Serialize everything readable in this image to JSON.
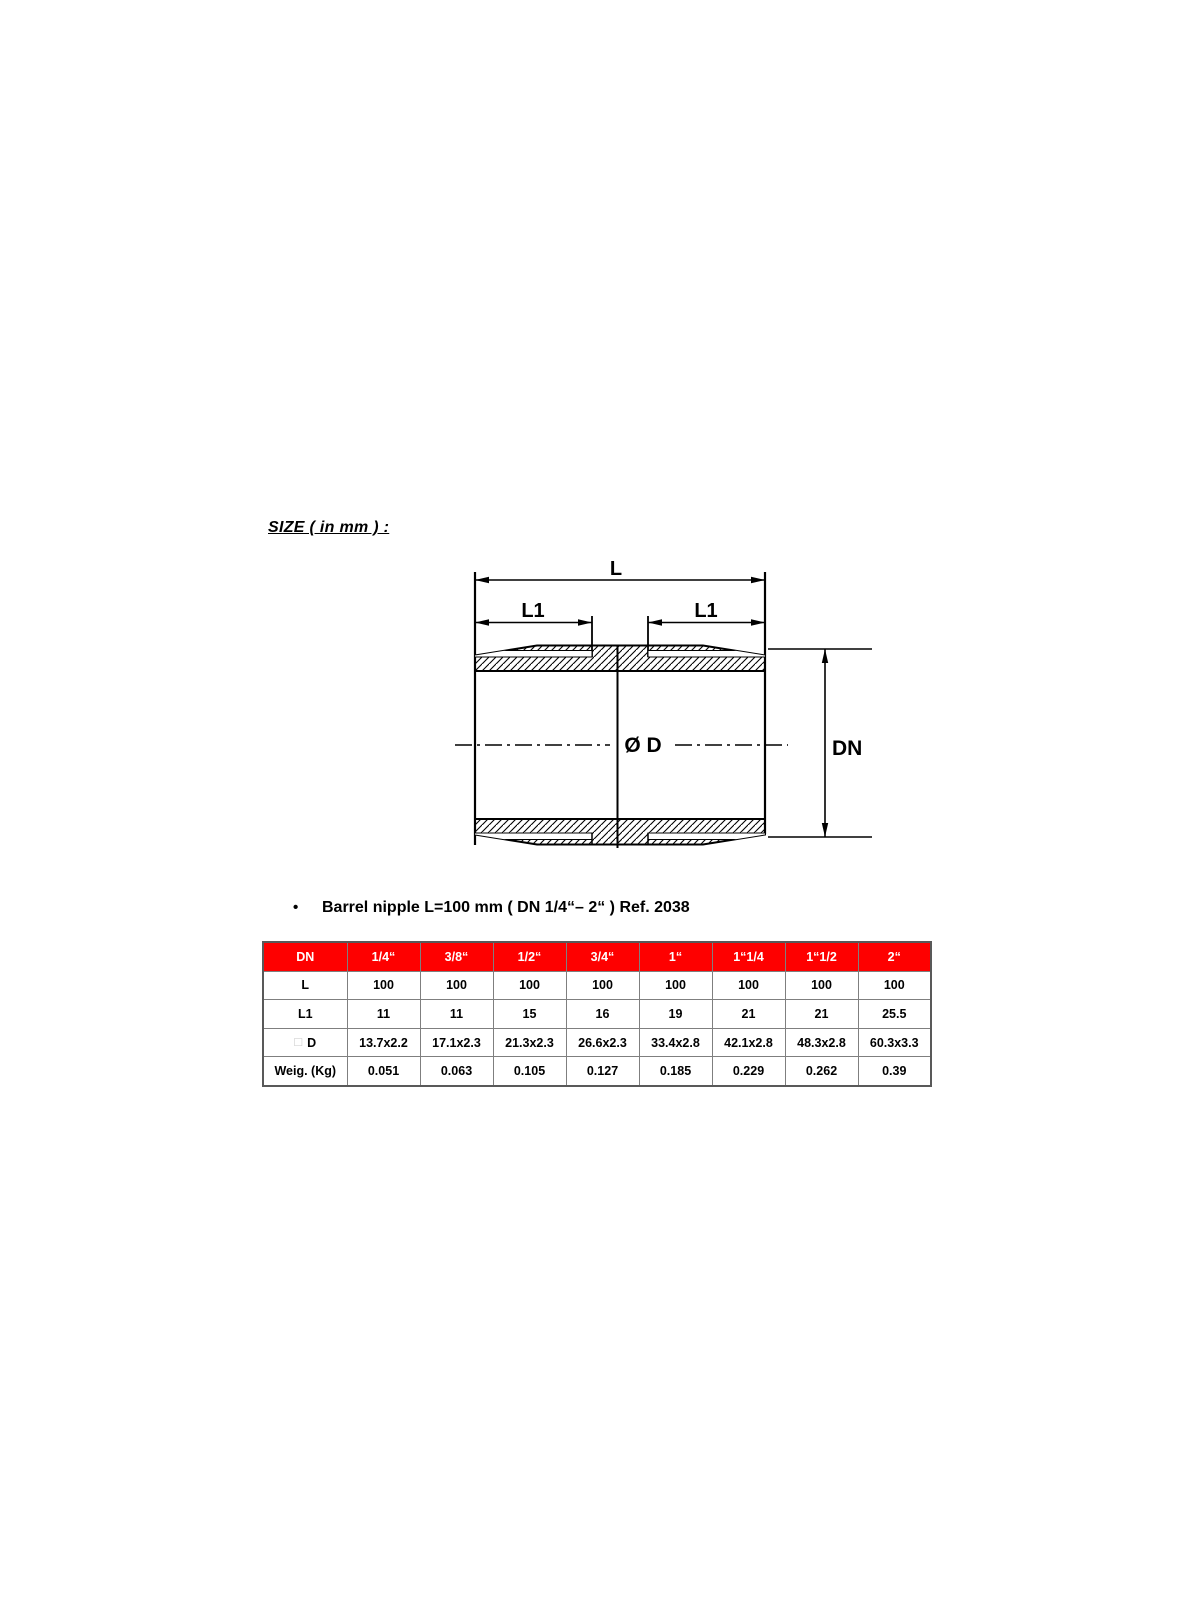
{
  "document": {
    "heading": "SIZE ( in mm ) :",
    "bullet_marker": "•",
    "bullet_text": "Barrel nipple L=100 mm ( DN 1/4“– 2“ ) Ref. 2038"
  },
  "diagram": {
    "label_L": "L",
    "label_L1_left": "L1",
    "label_L1_right": "L1",
    "label_diameter": "Ø D",
    "label_DN": "DN"
  },
  "table": {
    "header_label": "DN",
    "header_columns": [
      "1/4“",
      "3/8“",
      "1/2“",
      "3/4“",
      "1“",
      "1“1/4",
      "1“1/2",
      "2“"
    ],
    "rows": [
      {
        "label": "L",
        "values": [
          "100",
          "100",
          "100",
          "100",
          "100",
          "100",
          "100",
          "100"
        ]
      },
      {
        "label": "L1",
        "values": [
          "11",
          "11",
          "15",
          "16",
          "19",
          "21",
          "21",
          "25.5"
        ]
      },
      {
        "label": "D",
        "label_prefix": "□",
        "values": [
          "13.7x2.2",
          "17.1x2.3",
          "21.3x2.3",
          "26.6x2.3",
          "33.4x2.8",
          "42.1x2.8",
          "48.3x2.8",
          "60.3x3.3"
        ]
      },
      {
        "label": "Weig. (Kg)",
        "values": [
          "0.051",
          "0.063",
          "0.105",
          "0.127",
          "0.185",
          "0.229",
          "0.262",
          "0.39"
        ]
      }
    ]
  },
  "colors": {
    "header_bg": "#fe0000",
    "header_text": "#ffffff",
    "line": "#000000"
  }
}
